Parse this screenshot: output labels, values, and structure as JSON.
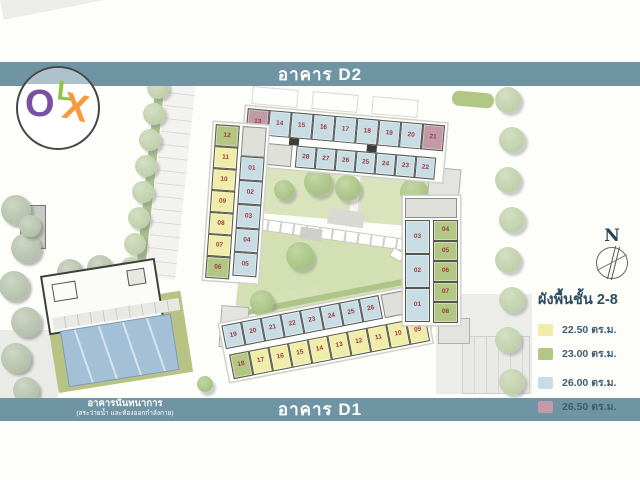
{
  "header": {
    "building_top": "อาคาร D2"
  },
  "footer": {
    "building_bottom": "อาคาร D1",
    "annex": {
      "title": "อาคารนันทนาการ",
      "subtitle": "(สระว่ายน้ำ และห้องออกกำลังกาย)"
    }
  },
  "logo": {
    "name": "OLX",
    "letters": [
      "O",
      "L",
      "X"
    ]
  },
  "compass": {
    "north": "N"
  },
  "legend": {
    "title": "ผังพื้นชั้น 2-8",
    "items": [
      {
        "color": "#f0edaa",
        "label": "22.50 ตร.ม."
      },
      {
        "color": "#b3c785",
        "label": "23.00 ตร.ม."
      },
      {
        "color": "#c8dde3",
        "label": "26.00 ตร.ม."
      },
      {
        "color": "#c29aa7",
        "label": "26.50 ตร.ม."
      }
    ]
  },
  "site": {
    "unit_colors": {
      "y": "#f0edaa",
      "g": "#b3c785",
      "b": "#c8dde3",
      "m": "#c29aa7"
    },
    "number_color": "#9e3a40",
    "d2": {
      "row_top": [
        {
          "n": "13",
          "t": "m"
        },
        {
          "n": "14",
          "t": "b"
        },
        {
          "n": "15",
          "t": "b"
        },
        {
          "n": "16",
          "t": "b"
        },
        {
          "n": "17",
          "t": "b"
        },
        {
          "n": "18",
          "t": "b"
        },
        {
          "n": "19",
          "t": "b"
        },
        {
          "n": "20",
          "t": "b"
        },
        {
          "n": "21",
          "t": "m"
        }
      ],
      "row_bottom": [
        {
          "n": "28",
          "t": "b"
        },
        {
          "n": "27",
          "t": "b"
        },
        {
          "n": "26",
          "t": "b"
        },
        {
          "n": "25",
          "t": "b"
        },
        {
          "n": "24",
          "t": "b"
        },
        {
          "n": "23",
          "t": "b"
        },
        {
          "n": "22",
          "t": "b"
        }
      ],
      "wing_left_col": [
        {
          "n": "12",
          "t": "g"
        },
        {
          "n": "11",
          "t": "y"
        },
        {
          "n": "10",
          "t": "y"
        },
        {
          "n": "09",
          "t": "y"
        },
        {
          "n": "08",
          "t": "y"
        },
        {
          "n": "07",
          "t": "y"
        },
        {
          "n": "06",
          "t": "g"
        }
      ],
      "wing_right_col": [
        {
          "n": "01",
          "t": "b"
        },
        {
          "n": "02",
          "t": "b"
        },
        {
          "n": "03",
          "t": "b"
        },
        {
          "n": "04",
          "t": "b"
        },
        {
          "n": "05",
          "t": "b"
        }
      ]
    },
    "d1": {
      "row_top": [
        {
          "n": "19",
          "t": "b"
        },
        {
          "n": "20",
          "t": "b"
        },
        {
          "n": "21",
          "t": "b"
        },
        {
          "n": "22",
          "t": "b"
        },
        {
          "n": "23",
          "t": "b"
        },
        {
          "n": "24",
          "t": "b"
        },
        {
          "n": "25",
          "t": "b"
        },
        {
          "n": "26",
          "t": "b"
        }
      ],
      "row_bottom": [
        {
          "n": "18",
          "t": "g"
        },
        {
          "n": "17",
          "t": "y"
        },
        {
          "n": "16",
          "t": "y"
        },
        {
          "n": "15",
          "t": "y"
        },
        {
          "n": "14",
          "t": "y"
        },
        {
          "n": "13",
          "t": "y"
        },
        {
          "n": "12",
          "t": "y"
        },
        {
          "n": "11",
          "t": "y"
        },
        {
          "n": "10",
          "t": "y"
        },
        {
          "n": "09",
          "t": "y"
        }
      ],
      "wing_left_col": [
        {
          "n": "03",
          "t": "b"
        },
        {
          "n": "02",
          "t": "b"
        },
        {
          "n": "01",
          "t": "b"
        }
      ],
      "wing_right_col": [
        {
          "n": "04",
          "t": "g"
        },
        {
          "n": "05",
          "t": "g"
        },
        {
          "n": "06",
          "t": "g"
        },
        {
          "n": "07",
          "t": "g"
        },
        {
          "n": "08",
          "t": "g"
        }
      ]
    }
  },
  "colors": {
    "bar": "#6f94a4",
    "bar_text": "#ffffff"
  }
}
